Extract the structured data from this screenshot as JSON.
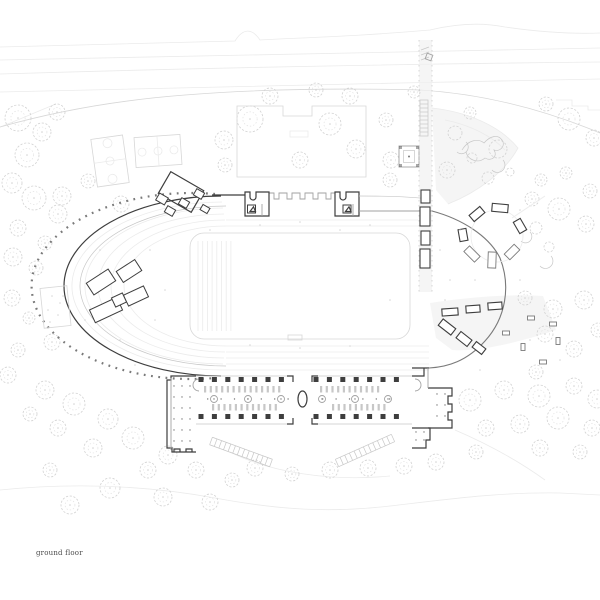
{
  "caption": {
    "label": "ground floor"
  },
  "palette": {
    "faint": "#ebebeb",
    "light": "#d7d7d7",
    "soft": "#c7c7c7",
    "medium": "#a2a2a2",
    "strong": "#7a7a7a",
    "dark": "#3e3e3e",
    "tree": "#d2d2d2",
    "tree2": "#e2e2e2",
    "wash": "#efefef",
    "text": "#4a4a4a"
  },
  "plan": {
    "trees": [
      [
        18,
        118,
        13
      ],
      [
        42,
        132,
        9
      ],
      [
        27,
        155,
        12
      ],
      [
        57,
        112,
        8
      ],
      [
        12,
        183,
        10
      ],
      [
        34,
        198,
        12
      ],
      [
        58,
        214,
        9
      ],
      [
        18,
        228,
        8
      ],
      [
        45,
        243,
        7
      ],
      [
        62,
        196,
        9
      ],
      [
        88,
        181,
        7
      ],
      [
        121,
        204,
        8
      ],
      [
        13,
        257,
        9
      ],
      [
        36,
        268,
        7
      ],
      [
        12,
        298,
        8
      ],
      [
        29,
        318,
        6
      ],
      [
        52,
        342,
        8
      ],
      [
        18,
        350,
        7
      ],
      [
        8,
        375,
        8
      ],
      [
        45,
        390,
        9
      ],
      [
        74,
        404,
        11
      ],
      [
        108,
        419,
        10
      ],
      [
        58,
        428,
        8
      ],
      [
        133,
        438,
        11
      ],
      [
        93,
        448,
        9
      ],
      [
        168,
        455,
        9
      ],
      [
        30,
        414,
        7
      ],
      [
        148,
        470,
        8
      ],
      [
        50,
        470,
        7
      ],
      [
        110,
        488,
        10
      ],
      [
        163,
        497,
        9
      ],
      [
        210,
        502,
        8
      ],
      [
        70,
        505,
        9
      ],
      [
        255,
        468,
        8
      ],
      [
        196,
        470,
        8
      ],
      [
        232,
        480,
        7
      ],
      [
        292,
        474,
        7
      ],
      [
        330,
        470,
        8
      ],
      [
        368,
        468,
        8
      ],
      [
        404,
        466,
        8
      ],
      [
        436,
        462,
        8
      ],
      [
        470,
        400,
        11
      ],
      [
        504,
        390,
        9
      ],
      [
        539,
        396,
        11
      ],
      [
        574,
        386,
        8
      ],
      [
        597,
        399,
        9
      ],
      [
        486,
        428,
        8
      ],
      [
        520,
        424,
        9
      ],
      [
        558,
        418,
        11
      ],
      [
        592,
        428,
        8
      ],
      [
        476,
        452,
        7
      ],
      [
        540,
        448,
        8
      ],
      [
        580,
        452,
        7
      ],
      [
        525,
        298,
        7
      ],
      [
        553,
        309,
        9
      ],
      [
        584,
        300,
        9
      ],
      [
        545,
        334,
        8
      ],
      [
        574,
        349,
        8
      ],
      [
        598,
        330,
        7
      ],
      [
        536,
        372,
        7
      ],
      [
        532,
        199,
        7
      ],
      [
        559,
        209,
        11
      ],
      [
        586,
        224,
        8
      ],
      [
        541,
        180,
        6
      ],
      [
        590,
        191,
        7
      ],
      [
        566,
        173,
        6
      ],
      [
        569,
        119,
        11
      ],
      [
        546,
        104,
        7
      ],
      [
        594,
        138,
        8
      ],
      [
        250,
        119,
        13
      ],
      [
        224,
        140,
        9
      ],
      [
        330,
        124,
        11
      ],
      [
        356,
        149,
        9
      ],
      [
        300,
        160,
        8
      ],
      [
        270,
        96,
        8
      ],
      [
        316,
        90,
        7
      ],
      [
        350,
        96,
        8
      ],
      [
        386,
        120,
        7
      ],
      [
        391,
        160,
        8
      ],
      [
        414,
        92,
        6
      ],
      [
        225,
        165,
        7
      ],
      [
        390,
        180,
        7
      ],
      [
        447,
        170,
        8
      ],
      [
        470,
        113,
        6
      ]
    ],
    "columns": {
      "size": 5,
      "rows": [
        379.5,
        416.5
      ],
      "wings": [
        {
          "x0": 201,
          "step": 13.4,
          "count": 7
        },
        {
          "x0": 316,
          "step": 13.4,
          "count": 7
        }
      ]
    },
    "furniture_strips": [
      {
        "x0": 204,
        "y": 386,
        "count": 14,
        "step": 5.7
      },
      {
        "x0": 212,
        "y": 404,
        "count": 12,
        "step": 5.7
      },
      {
        "x0": 320,
        "y": 386,
        "count": 11,
        "step": 5.7
      },
      {
        "x0": 332,
        "y": 404,
        "count": 10,
        "step": 5.7
      }
    ],
    "tables_round": [
      [
        214,
        399
      ],
      [
        248,
        399
      ],
      [
        281,
        399
      ],
      [
        322,
        399
      ],
      [
        355,
        399
      ],
      [
        388,
        399
      ]
    ],
    "dot_rows": [
      {
        "x0": 207.7,
        "y": 399,
        "count": 7,
        "step": 13.4
      },
      {
        "x0": 322.7,
        "y": 399,
        "count": 6,
        "step": 13.4
      }
    ],
    "dot_grids": [
      {
        "x0": 174,
        "y0": 386,
        "nx": 3,
        "ny": 6,
        "sx": 8,
        "sy": 11
      },
      {
        "x0": 437,
        "y0": 394,
        "nx": 2,
        "ny": 3,
        "sx": 8,
        "sy": 11
      },
      {
        "x0": 416,
        "y0": 432,
        "nx": 2,
        "ny": 2,
        "sx": 8,
        "sy": 8
      }
    ],
    "benches_path": [
      [
        421,
        190,
        9,
        13
      ],
      [
        420,
        207,
        10,
        19
      ],
      [
        421,
        231,
        9,
        14
      ],
      [
        420,
        249,
        10,
        19
      ]
    ],
    "tables_terrace": [
      [
        450,
        312,
        16,
        7,
        -4
      ],
      [
        473,
        309,
        14,
        7,
        -4
      ],
      [
        495,
        306,
        14,
        7,
        -4
      ],
      [
        447,
        327,
        16,
        8,
        38
      ],
      [
        464,
        339,
        14,
        8,
        38
      ],
      [
        479,
        348,
        12,
        7,
        38
      ]
    ],
    "benches_scatter": [
      [
        506,
        333,
        7,
        4,
        0
      ],
      [
        523,
        347,
        7,
        4,
        90
      ],
      [
        531,
        318,
        7,
        4,
        0
      ],
      [
        553,
        324,
        7,
        4,
        0
      ],
      [
        558,
        341,
        7,
        4,
        90
      ],
      [
        543,
        362,
        7,
        4,
        0
      ]
    ],
    "cluster_north": {
      "cx": 181,
      "cy": 192,
      "w": 38,
      "h": 25,
      "rot": 30,
      "rooms": [
        [
          162,
          199,
          10,
          8
        ],
        [
          170,
          211,
          9,
          7
        ],
        [
          184,
          203,
          9,
          7
        ],
        [
          199,
          194,
          9,
          7
        ],
        [
          205,
          209,
          8,
          6
        ]
      ]
    },
    "cluster_west": [
      [
        101,
        282,
        26,
        14,
        -33
      ],
      [
        129,
        271,
        22,
        13,
        -33
      ],
      [
        106,
        310,
        30,
        14,
        -25
      ],
      [
        119,
        300,
        12,
        10,
        -25
      ],
      [
        136,
        296,
        22,
        12,
        -25
      ]
    ],
    "pavilion_circle": {
      "cx": 497,
      "cy": 236,
      "r": 26,
      "segments_dark": [
        [
          500,
          208,
          16,
          8,
          5
        ],
        [
          477,
          214,
          14,
          8,
          -40
        ],
        [
          520,
          226,
          13,
          8,
          60
        ],
        [
          463,
          235,
          12,
          8,
          80
        ]
      ],
      "segments_light": [
        [
          472,
          254,
          15,
          8,
          45
        ],
        [
          492,
          260,
          16,
          8,
          92
        ],
        [
          512,
          252,
          14,
          8,
          135
        ]
      ]
    },
    "ramps": [
      {
        "x1": 211,
        "y1": 441,
        "x2": 271,
        "y2": 463,
        "w": 8,
        "n": 13
      },
      {
        "x1": 393,
        "y1": 438,
        "x2": 337,
        "y2": 463,
        "w": 8,
        "n": 12
      }
    ],
    "dots": [
      [
        210,
        230
      ],
      [
        260,
        225
      ],
      [
        300,
        222
      ],
      [
        150,
        250
      ],
      [
        165,
        290
      ],
      [
        155,
        320
      ],
      [
        120,
        340
      ],
      [
        440,
        250
      ],
      [
        450,
        280
      ],
      [
        445,
        300
      ],
      [
        460,
        230
      ],
      [
        475,
        280
      ],
      [
        520,
        280
      ],
      [
        530,
        340
      ],
      [
        560,
        360
      ],
      [
        480,
        370
      ],
      [
        340,
        230
      ],
      [
        370,
        225
      ],
      [
        250,
        345
      ],
      [
        300,
        348
      ],
      [
        350,
        346
      ],
      [
        390,
        300
      ],
      [
        100,
        250
      ],
      [
        85,
        320
      ],
      [
        135,
        365
      ],
      [
        520,
        210
      ],
      [
        52,
        296
      ],
      [
        60,
        303
      ],
      [
        48,
        310
      ],
      [
        58,
        315
      ],
      [
        50,
        322
      ],
      [
        63,
        296
      ]
    ]
  }
}
